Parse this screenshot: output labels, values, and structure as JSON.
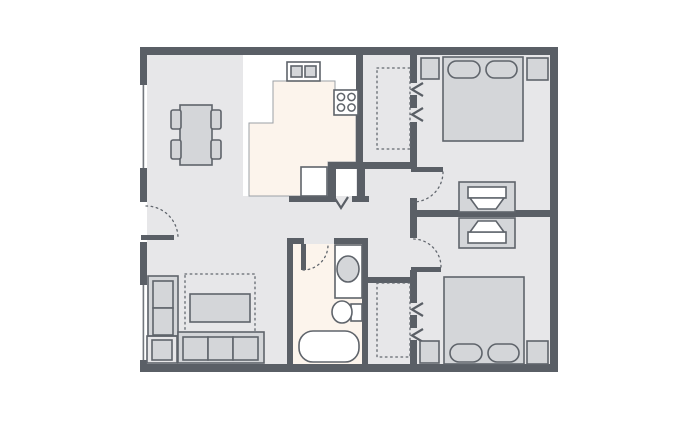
{
  "title": "Two-bedroom apartment floor plan",
  "colors": {
    "background": "#ffffff",
    "wall": "#5a5f66",
    "floor": "#e7e7e9",
    "kitchen_floor": "#fcf4ec",
    "counter": "#ffffff",
    "furniture_fill": "#d4d6d9",
    "furniture_outline": "#5f646b",
    "dotted": "#62676e",
    "soft_edge": "#9ba0a6"
  },
  "rooms": [
    {
      "name": "living-dining-room",
      "furniture": [
        "dining-table",
        "dining-chair x4",
        "loveseat",
        "sofa (3-seat)",
        "end-table",
        "coffee-table",
        "area-rug (dotted)"
      ]
    },
    {
      "name": "kitchen",
      "furniture": [
        "l-shaped-counter",
        "double-basin-sink",
        "stove (4 burners)",
        "appliance-square",
        "pantry-closet (swing-door mark)"
      ]
    },
    {
      "name": "hallway",
      "furniture": []
    },
    {
      "name": "bedroom-1",
      "furniture": [
        "double-bed",
        "pillow x2",
        "nightstand x2",
        "dresser-with-tv",
        "closet (dotted, bifold chevrons x2)"
      ]
    },
    {
      "name": "bedroom-2",
      "furniture": [
        "double-bed",
        "pillow x2",
        "nightstand x2",
        "dresser-with-tv",
        "closet (dotted, bifold chevrons x2)"
      ]
    },
    {
      "name": "bathroom",
      "furniture": [
        "vanity-sink",
        "toilet",
        "bathtub"
      ]
    }
  ],
  "doors": [
    {
      "name": "entry-door",
      "wall": "left-exterior",
      "swing": "dotted-arc"
    },
    {
      "name": "bedroom-1-door",
      "swing": "dotted-arc"
    },
    {
      "name": "bedroom-2-door",
      "swing": "dotted-arc"
    },
    {
      "name": "bathroom-door",
      "swing": "dotted-arc"
    }
  ],
  "windows": [
    {
      "name": "window-upper-left",
      "wall": "left-exterior"
    },
    {
      "name": "window-lower-left",
      "wall": "left-exterior"
    }
  ]
}
